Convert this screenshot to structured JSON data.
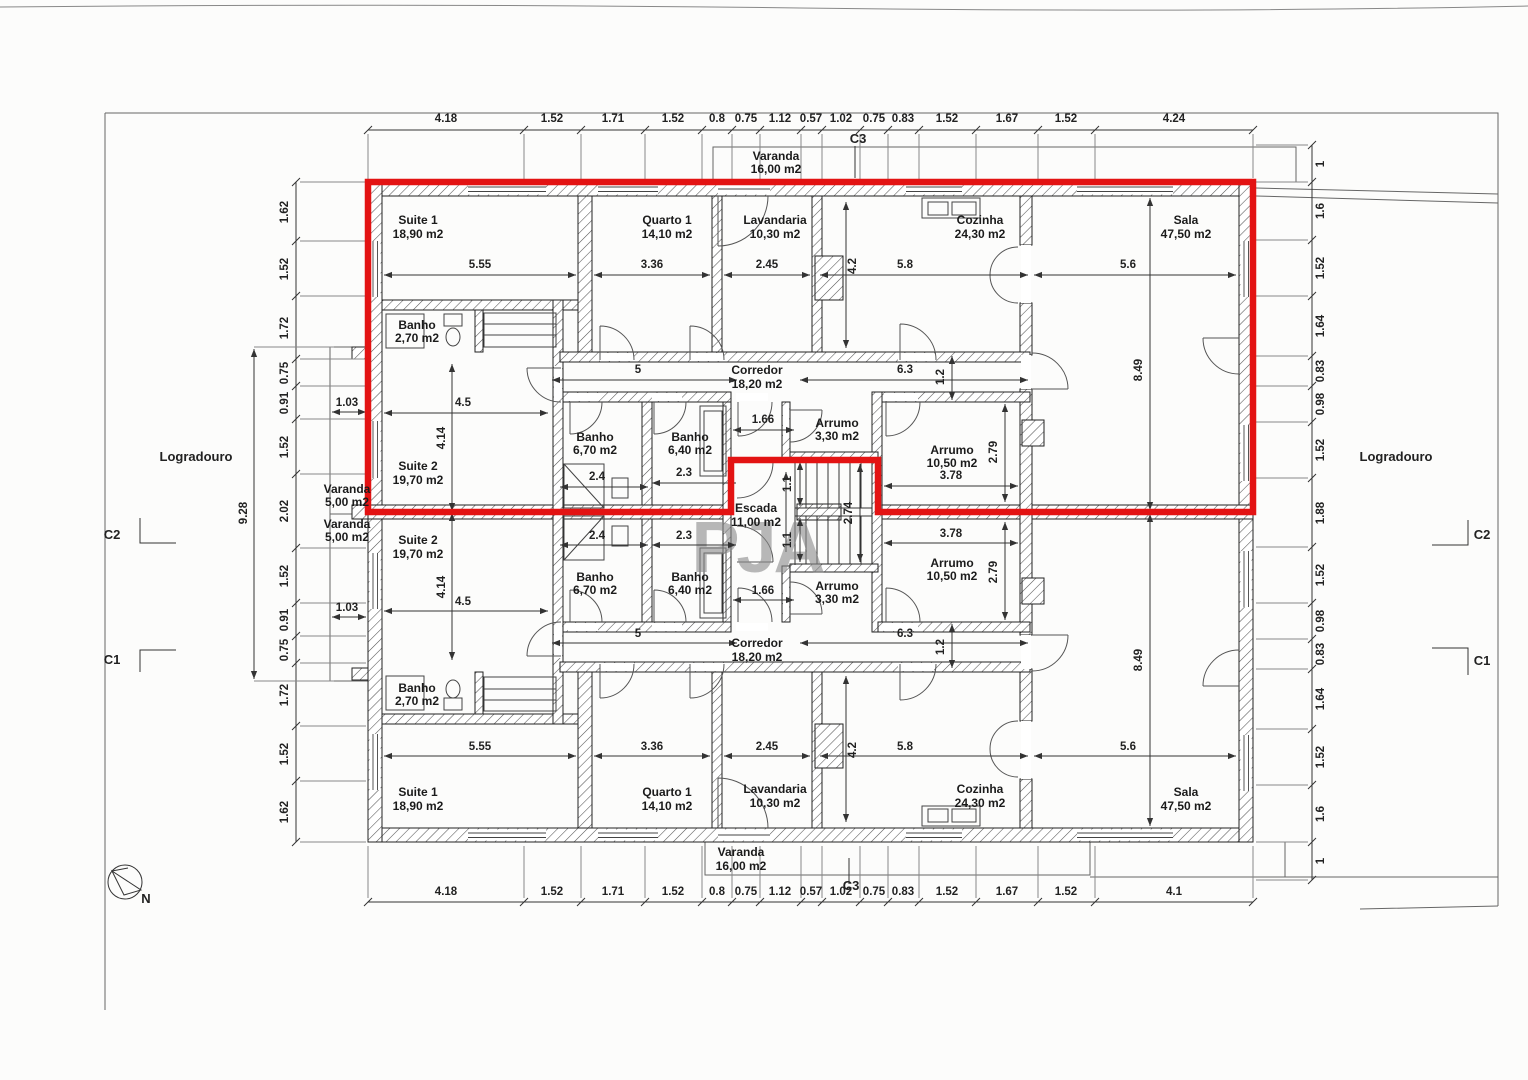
{
  "watermark": "PJA",
  "site": {
    "left_label": "Logradouro",
    "right_label": "Logradouro",
    "north": "N",
    "c1": "C1",
    "c2": "C2",
    "c3": "C3"
  },
  "rooms": {
    "suite1": {
      "name": "Suite 1",
      "area": "18,90 m2"
    },
    "quarto1": {
      "name": "Quarto 1",
      "area": "14,10 m2"
    },
    "lavandaria": {
      "name": "Lavandaria",
      "area": "10,30 m2"
    },
    "cozinha": {
      "name": "Cozinha",
      "area": "24,30 m2"
    },
    "sala": {
      "name": "Sala",
      "area": "47,50 m2"
    },
    "banho_suite1": {
      "name": "Banho",
      "area": "2,70 m2"
    },
    "suite2": {
      "name": "Suite 2",
      "area": "19,70 m2"
    },
    "banho_670": {
      "name": "Banho",
      "area": "6,70 m2"
    },
    "banho_640": {
      "name": "Banho",
      "area": "6,40 m2"
    },
    "arrumo_330": {
      "name": "Arrumo",
      "area": "3,30 m2"
    },
    "arrumo_1050": {
      "name": "Arrumo",
      "area": "10,50 m2"
    },
    "corredor": {
      "name": "Corredor",
      "area": "18,20 m2"
    },
    "escada": {
      "name": "Escada",
      "area": "11,00 m2"
    },
    "varanda_16": {
      "name": "Varanda",
      "area": "16,00 m2"
    },
    "varanda_5": {
      "name": "Varanda",
      "area": "5,00 m2"
    }
  },
  "dims": {
    "top": [
      "4.18",
      "1.52",
      "1.71",
      "1.52",
      "0.8",
      "0.75",
      "1.12",
      "0.57",
      "1.02",
      "0.75",
      "0.83",
      "1.52",
      "1.67",
      "1.52",
      "4.24"
    ],
    "bottom": [
      "4.18",
      "1.52",
      "1.71",
      "1.52",
      "0.8",
      "0.75",
      "1.12",
      "0.57",
      "1.02",
      "0.75",
      "0.83",
      "1.52",
      "1.67",
      "1.52",
      "4.1"
    ],
    "left": [
      "1.62",
      "1.52",
      "1.72",
      "0.75",
      "0.91",
      "1.52",
      "2.02",
      "1.52",
      "0.91",
      "0.75",
      "1.72",
      "1.52",
      "1.62"
    ],
    "right": [
      "1",
      "1.6",
      "1.52",
      "1.64",
      "0.83",
      "0.98",
      "1.52",
      "1.88",
      "1.52",
      "0.98",
      "0.83",
      "1.64",
      "1.52",
      "1.6",
      "1"
    ],
    "left_total": "9.28",
    "left_balcony": "1.03",
    "interior": {
      "s1w": "5.55",
      "q1w": "3.36",
      "lvw": "2.45",
      "shaft": "4.2",
      "czw": "5.8",
      "slw": "5.6",
      "sld": "8.49",
      "c5": "5",
      "c63": "6.3",
      "cw": "1.2",
      "s2w": "4.5",
      "s2d": "4.14",
      "b1w": "2.4",
      "b2w": "2.3",
      "lob": "1.66",
      "arw": "3.78",
      "ard": "2.79",
      "st1": "1.1",
      "st2": "2.74"
    }
  },
  "colors": {
    "highlight": "#e31313",
    "wall_line": "#222222",
    "dim_line": "#333333",
    "watermark_gray": "#8a8a8a"
  }
}
